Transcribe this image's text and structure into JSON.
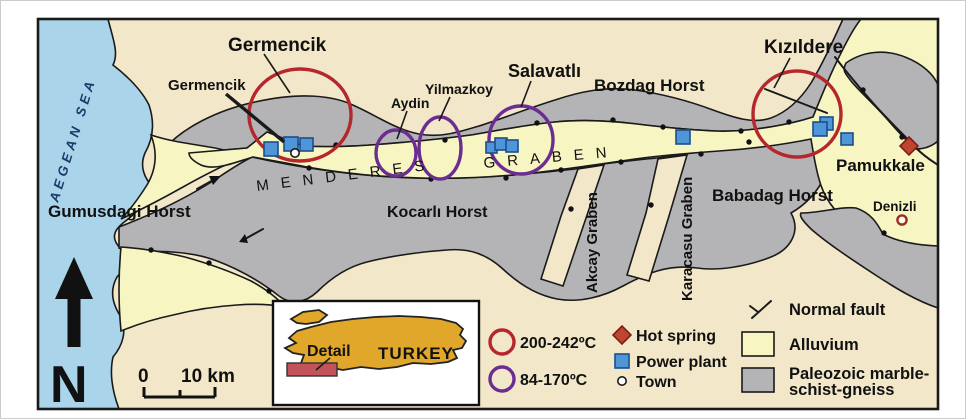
{
  "map": {
    "sea_label": "AEGEAN SEA",
    "geothermal_fields": {
      "germencik": "Germencik",
      "salavatli": "Salavatlı",
      "kizildere": "Kızıldere"
    },
    "towns": {
      "germencik": "Germencik",
      "aydin": "Aydin",
      "yilmazkoy": "Yilmazkoy",
      "pamukkale": "Pamukkale",
      "denizli": "Denizli"
    },
    "structures": {
      "gumusdagi_horst": "Gumusdagi Horst",
      "kocarli_horst": "Kocarlı Horst",
      "bozdag_horst": "Bozdag Horst",
      "babadag_horst": "Babadag Horst",
      "menderes": "MENDERES",
      "graben": "GRABEN",
      "akcay_graben": "Akcay Graben",
      "karacasu_graben": "Karacasu Graben"
    },
    "north_label": "N",
    "scale": {
      "zero": "0",
      "ten_km": "10 km"
    },
    "inset": {
      "detail": "Detail",
      "country": "TURKEY"
    },
    "legend": {
      "high_temp": "200-242ºC",
      "low_temp": "84-170ºC",
      "hot_spring": "Hot spring",
      "power_plant": "Power plant",
      "town": "Town",
      "normal_fault": "Normal fault",
      "alluvium": "Alluvium",
      "paleozoic_line1": "Paleozoic marble-",
      "paleozoic_line2": "schist-gneiss"
    },
    "colors": {
      "sea": "#a9d4ea",
      "background_tan": "#f2e7c8",
      "alluvium": "#f7f6c2",
      "paleozoic_gray": "#b4b4b6",
      "high_temp_ring": "#b5272c",
      "low_temp_ring": "#6b2e90",
      "power_plant_blue": "#4e96d8",
      "hot_spring_red": "#c04530",
      "turkey_gold": "#e1a72b",
      "detail_rect": "#c3535b"
    }
  }
}
